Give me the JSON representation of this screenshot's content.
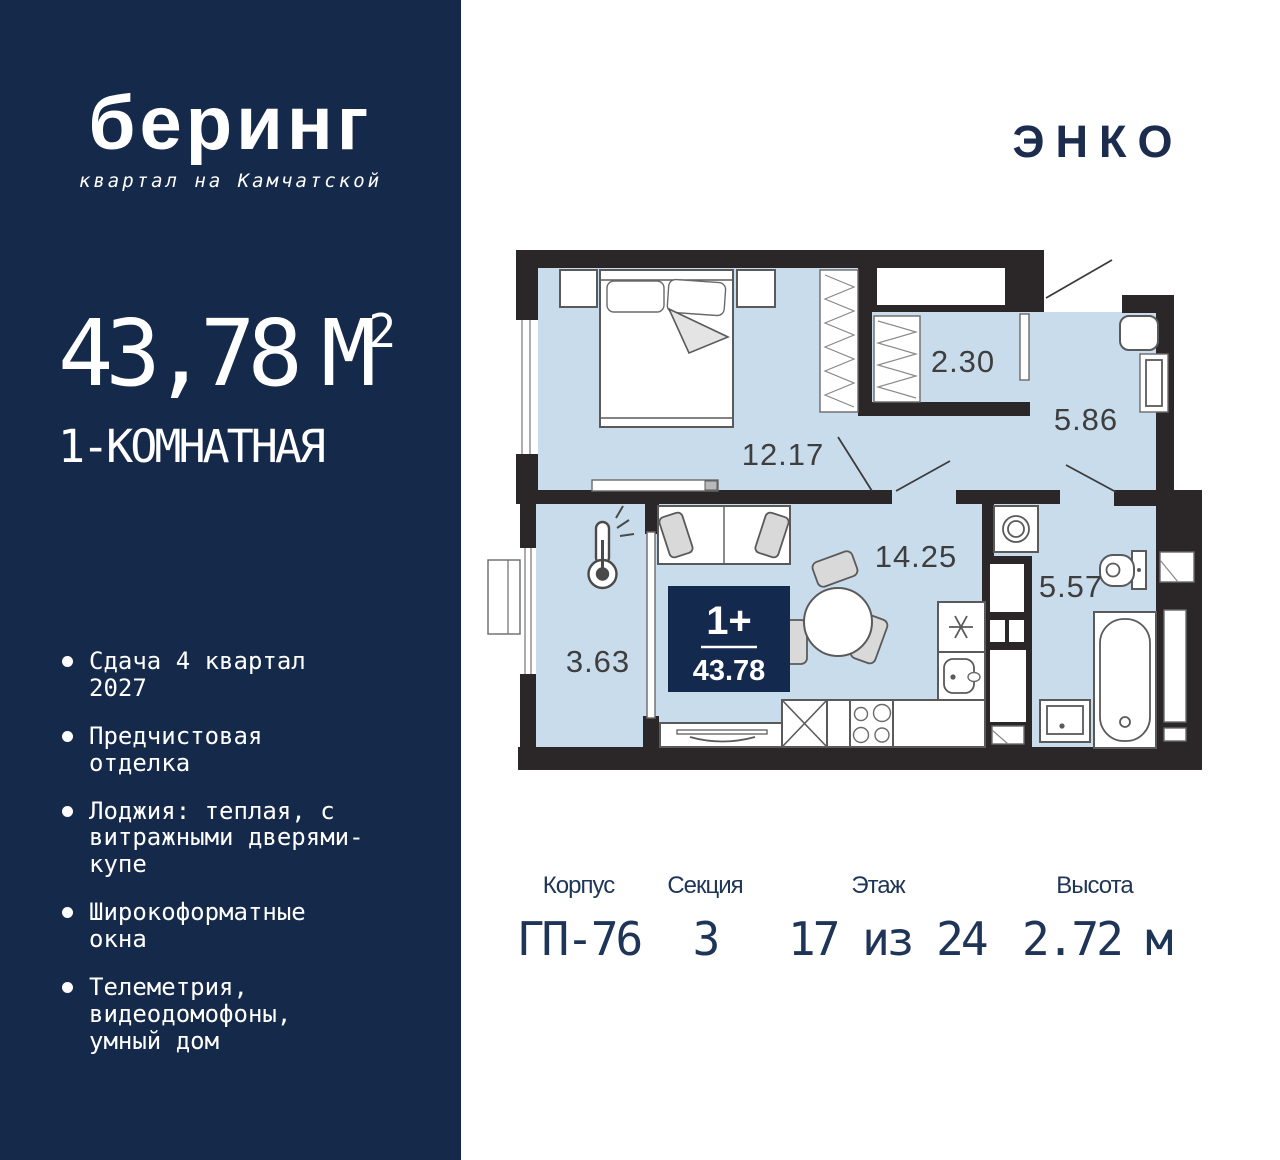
{
  "brand": {
    "logo_text": "беринг",
    "logo_subtitle": "квартал на Камчатской",
    "developer_logo": "ЭНКО"
  },
  "sidebar": {
    "area_value": "43,78",
    "area_unit": "М",
    "area_sup": "2",
    "apartment_type": "1-КОМНАТНАЯ",
    "features": [
      "Сдача 4 квартал 2027",
      "Предчистовая отделка",
      "Лоджия: теплая, с витражными дверями-купе",
      "Широкоформатные окна",
      "Телеметрия, видеодомофоны, умный дом"
    ]
  },
  "floorplan": {
    "badge": {
      "rooms": "1+",
      "area": "43.78"
    },
    "room_areas": {
      "bedroom": "12.17",
      "wardrobe": "2.30",
      "hallway": "5.86",
      "kitchen_living": "14.25",
      "bathroom": "5.57",
      "loggia": "3.63"
    },
    "icons": [
      "thermometer-icon",
      "bed-icon",
      "wardrobe-icon",
      "sofa-icon",
      "dining-table-icon",
      "kitchen-sink-icon",
      "cooktop-icon",
      "washing-machine-icon",
      "toilet-icon",
      "bathtub-icon",
      "bathroom-sink-icon",
      "vent-shaft-icon"
    ]
  },
  "details": {
    "columns": [
      {
        "label": "Корпус",
        "value": "ГП-76"
      },
      {
        "label": "Секция",
        "value": "3"
      },
      {
        "label": "Этаж",
        "value": "17 из 24"
      },
      {
        "label": "Высота",
        "value": "2.72 м"
      }
    ]
  },
  "colors": {
    "sidebar_navy": "#15294a",
    "badge_navy": "#13294e",
    "room_fill": "#c9dcec",
    "wall": "#2b2728",
    "details_text": "#1e3557"
  }
}
